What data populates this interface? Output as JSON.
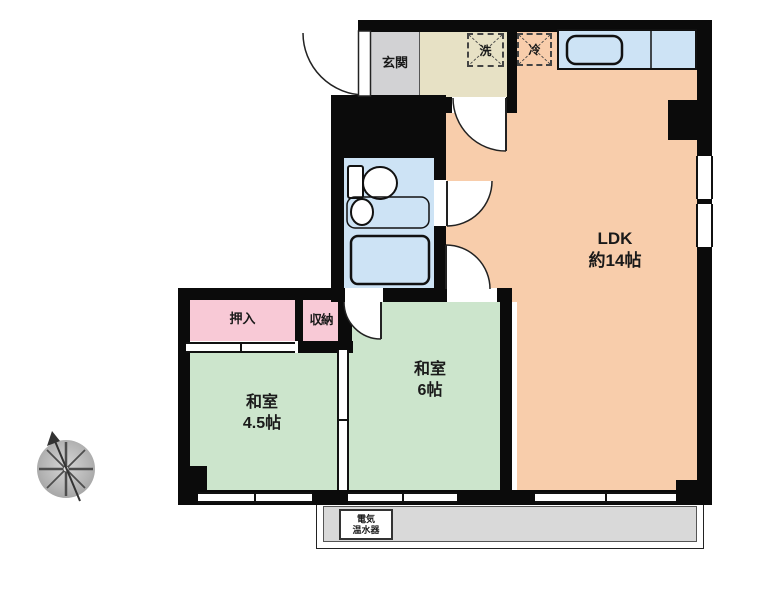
{
  "rooms": {
    "ldk": {
      "label": "LDK",
      "size": "約14帖"
    },
    "washitsu_6": {
      "label": "和室",
      "size": "6帖"
    },
    "washitsu_45": {
      "label": "和室",
      "size": "4.5帖"
    },
    "oshiire": {
      "label": "押入"
    },
    "shuno": {
      "label": "収納"
    },
    "genkan": {
      "label": "玄関"
    }
  },
  "fixtures": {
    "washer_label": "洗",
    "fridge_label": "冷",
    "water_heater_line1": "電気",
    "water_heater_line2": "温水器"
  },
  "colors": {
    "wall": "#0b0b0b",
    "ldk_fill": "#f8cdab",
    "tatami_fill": "#cce5cc",
    "closet_fill": "#f8c9d6",
    "bath_fill": "#cde3f5",
    "washroom_fill": "#e7e1c5",
    "genkan_fill": "#d2d2d4",
    "balcony_fill": "#d9d9d9"
  }
}
